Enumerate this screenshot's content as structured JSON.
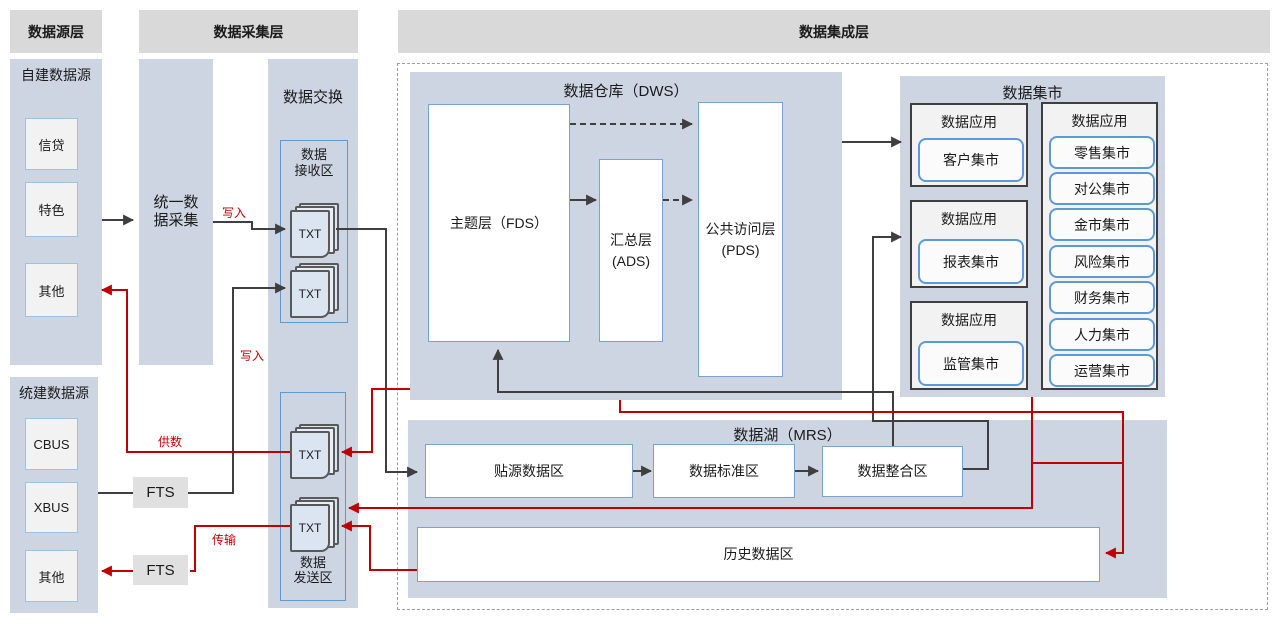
{
  "headers": {
    "source": "数据源层",
    "collect": "数据采集层",
    "integration": "数据集成层"
  },
  "source_layer": {
    "self_built": {
      "title": "自建数据源",
      "items": [
        "信贷",
        "特色",
        "其他"
      ]
    },
    "system_built": {
      "title": "统建数据源",
      "items": [
        "CBUS",
        "XBUS",
        "其他"
      ]
    }
  },
  "collect_layer": {
    "unified_lines": [
      "统一数",
      "据采集"
    ],
    "fts_top": "FTS",
    "fts_bottom": "FTS"
  },
  "exchange": {
    "title": "数据交换",
    "receive_lines": [
      "数据",
      "接收区"
    ],
    "send_lines": [
      "数据",
      "发送区"
    ],
    "txt_label": "TXT"
  },
  "flow_labels": {
    "write_top": "写入",
    "write_bottom": "写入",
    "supply": "供数",
    "transfer": "传输"
  },
  "dws": {
    "title": "数据仓库（DWS）",
    "fds": "主题层（FDS）",
    "ads_lines": [
      "汇总层",
      "(ADS)"
    ],
    "pds_lines": [
      "公共访问层",
      "(PDS)"
    ]
  },
  "mart": {
    "title": "数据集市",
    "apps": [
      {
        "title": "数据应用",
        "item": "客户集市"
      },
      {
        "title": "数据应用",
        "item": "报表集市"
      },
      {
        "title": "数据应用",
        "item": "监管集市"
      }
    ],
    "list_app": {
      "title": "数据应用",
      "items": [
        "零售集市",
        "对公集市",
        "金市集市",
        "风险集市",
        "财务集市",
        "人力集市",
        "运营集市"
      ]
    }
  },
  "mrs": {
    "title": "数据湖（MRS）",
    "zones": [
      "贴源数据区",
      "数据标准区",
      "数据整合区"
    ],
    "history": "历史数据区"
  },
  "colors": {
    "accent_red": "#c00000",
    "line_black": "#3f3f3f",
    "panel_blue": "#cdd5e3",
    "header_gray": "#d9d9d9"
  }
}
